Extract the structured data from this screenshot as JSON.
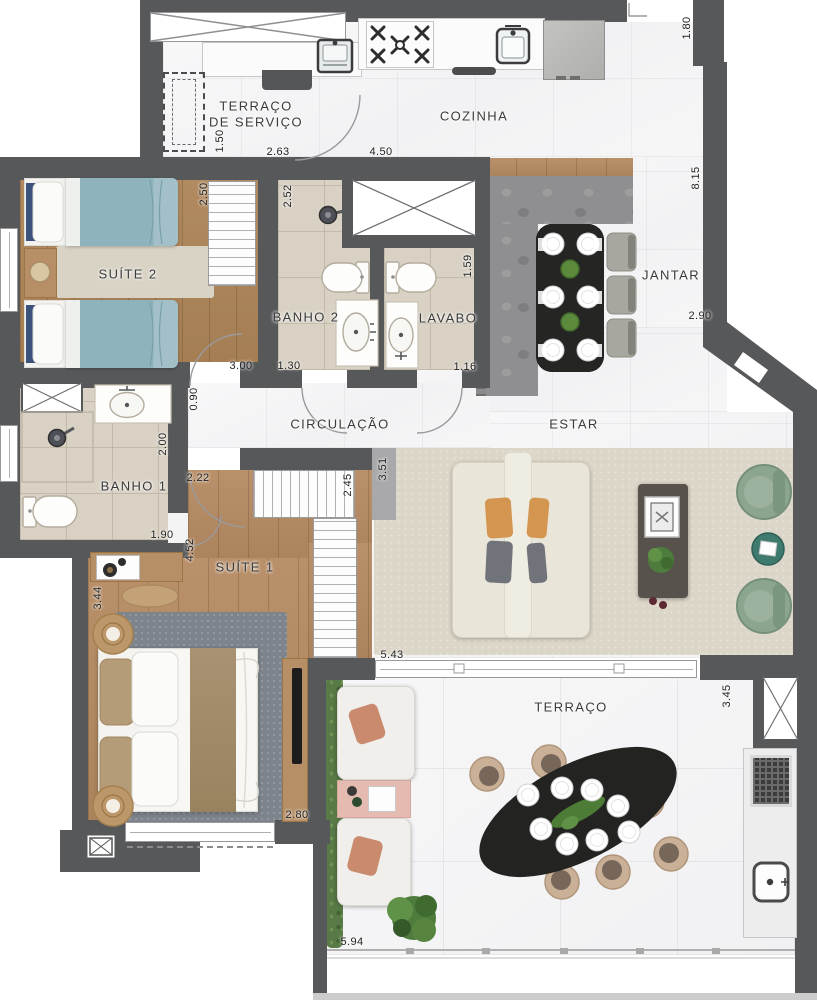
{
  "plan": {
    "title": "apartment floor plan",
    "rooms": {
      "terraco_servico_l1": "TERRAÇO",
      "terraco_servico_l2": "DE SERVIÇO",
      "cozinha": "COZINHA",
      "suite2": "SUÍTE 2",
      "banho2": "BANHO 2",
      "lavabo": "LAVABO",
      "jantar": "JANTAR",
      "circulacao": "CIRCULAÇÃO",
      "estar": "ESTAR",
      "banho1": "BANHO 1",
      "suite1": "SUÍTE 1",
      "terraco": "TERRAÇO"
    },
    "dimensions": {
      "d150": "1.50",
      "d263": "2.63",
      "d450": "4.50",
      "d180": "1.80",
      "d815": "8.15",
      "d250": "2.50",
      "d252": "2.52",
      "d159": "1.59",
      "d300": "3.00",
      "d130": "1.30",
      "d116": "1.16",
      "d290": "2.90",
      "d090": "0.90",
      "d200": "2.00",
      "d190": "1.90",
      "d222": "2.22",
      "d245": "2.45",
      "d351": "3.51",
      "d452": "4.52",
      "d344": "3.44",
      "d543": "5.43",
      "d280": "2.80",
      "d345": "3.45",
      "d594": "5.94"
    },
    "colors": {
      "wall": "#57585a",
      "wood_floor": "#ad8660",
      "bath_floor": "#d8d1c4",
      "stone_wall": "#8f8f91",
      "hedge_green": "#587a46",
      "armchair_green": "#8ba58f",
      "bed_teal": "#8fb3bc",
      "label_text": "#3b3b3c"
    }
  }
}
